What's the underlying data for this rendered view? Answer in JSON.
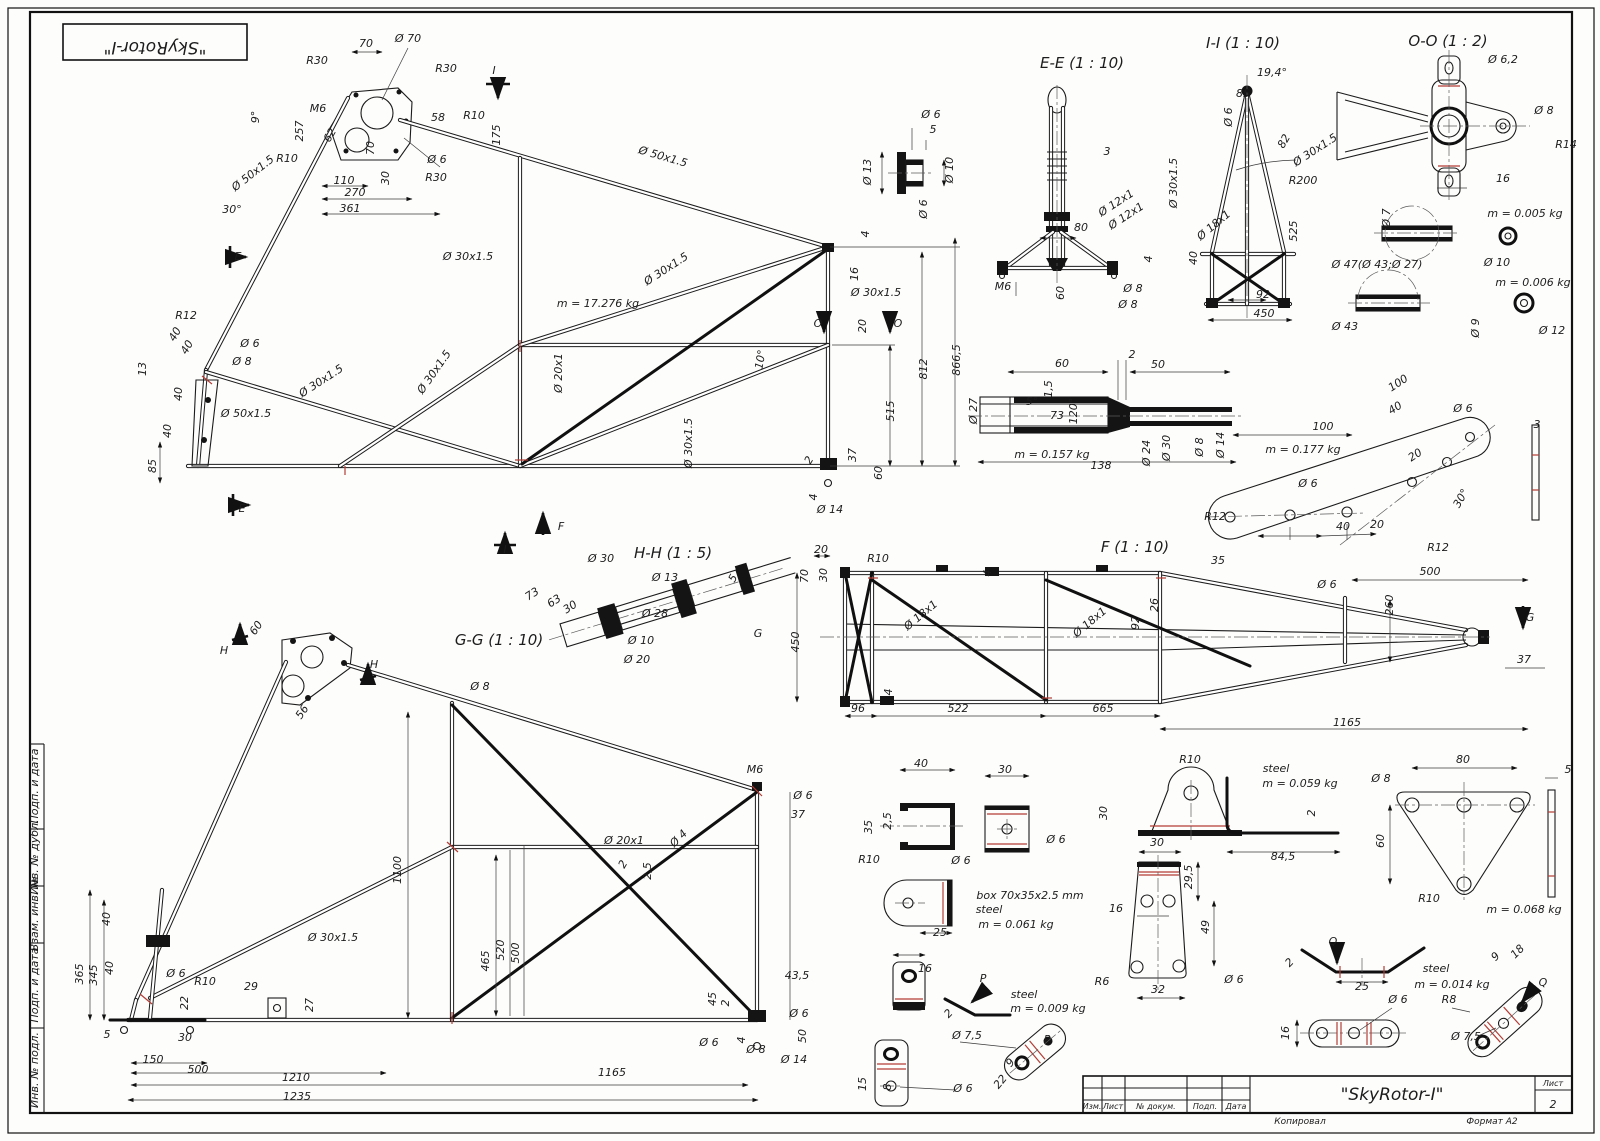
{
  "stamp": {
    "text": "\"SkyRotor-I\""
  },
  "title_block": {
    "title": "\"SkyRotor-I\"",
    "sheet_label": "Лист",
    "sheet_number": "2",
    "col_izm": "Изм.",
    "col_list": "Лист",
    "col_doc": "№ докум.",
    "col_sign": "Подп.",
    "col_date": "Дата",
    "footer_left": "Копировал",
    "footer_right": "Формат А2"
  },
  "views": {
    "section_ee": "E-E (1 : 10)",
    "section_ii": "I-I (1 : 10)",
    "section_oo": "O-O (1 : 2)",
    "section_hh": "H-H (1 : 5)",
    "section_gg": "G-G (1 : 10)",
    "view_f": "F (1 : 10)"
  },
  "masses": {
    "main_frame": "m = 17.276 kg",
    "coupler": "m = 0.157 kg",
    "strap": "m = 0.177 kg",
    "washer_small": "m = 0.005 kg",
    "washer_big": "m = 0.006 kg",
    "u_bracket": "m = 0.061 kg",
    "angle": "m = 0.059 kg",
    "triangle": "m = 0.068 kg",
    "p_bracket": "m = 0.009 kg",
    "q_bracket": "m = 0.014 kg"
  },
  "annotations": [
    {
      "t": "R30",
      "x": 317,
      "y": 64
    },
    {
      "t": "70",
      "x": 366,
      "y": 47
    },
    {
      "t": "Ø 70",
      "x": 408,
      "y": 42
    },
    {
      "t": "R30",
      "x": 446,
      "y": 72
    },
    {
      "t": "I",
      "x": 494,
      "y": 74,
      "fs": 14
    },
    {
      "t": "M6",
      "x": 318,
      "y": 112
    },
    {
      "t": "257",
      "x": 303,
      "y": 131,
      "r": -90
    },
    {
      "t": "9°",
      "x": 259,
      "y": 117,
      "r": -90
    },
    {
      "t": "62",
      "x": 333,
      "y": 137,
      "r": -60
    },
    {
      "t": "58",
      "x": 438,
      "y": 121
    },
    {
      "t": "R10",
      "x": 474,
      "y": 119
    },
    {
      "t": "175",
      "x": 500,
      "y": 135,
      "r": -90
    },
    {
      "t": "R10",
      "x": 287,
      "y": 162
    },
    {
      "t": "110",
      "x": 344,
      "y": 184
    },
    {
      "t": "70",
      "x": 374,
      "y": 148,
      "r": -90
    },
    {
      "t": "30",
      "x": 389,
      "y": 178,
      "r": -90
    },
    {
      "t": "Ø 6",
      "x": 437,
      "y": 163
    },
    {
      "t": "R30",
      "x": 436,
      "y": 181
    },
    {
      "t": "270",
      "x": 355,
      "y": 196
    },
    {
      "t": "361",
      "x": 350,
      "y": 212
    },
    {
      "t": "Ø 50x1.5",
      "x": 255,
      "y": 176,
      "r": -38
    },
    {
      "t": "30°",
      "x": 232,
      "y": 213
    },
    {
      "t": "Ø 50x1.5",
      "x": 662,
      "y": 160,
      "r": 16
    },
    {
      "t": "E",
      "x": 238,
      "y": 260,
      "fs": 14
    },
    {
      "t": "E",
      "x": 242,
      "y": 512,
      "fs": 14
    },
    {
      "t": "R12",
      "x": 186,
      "y": 319
    },
    {
      "t": "40",
      "x": 178,
      "y": 336,
      "r": -60
    },
    {
      "t": "40",
      "x": 190,
      "y": 349,
      "r": -60
    },
    {
      "t": "13",
      "x": 146,
      "y": 369,
      "r": -90
    },
    {
      "t": "Ø 6",
      "x": 250,
      "y": 347
    },
    {
      "t": "Ø 8",
      "x": 242,
      "y": 365
    },
    {
      "t": "40",
      "x": 182,
      "y": 394,
      "r": -90
    },
    {
      "t": "40",
      "x": 171,
      "y": 431,
      "r": -90
    },
    {
      "t": "Ø 50x1.5",
      "x": 246,
      "y": 417
    },
    {
      "t": "Ø 30x1.5",
      "x": 323,
      "y": 384,
      "r": -33
    },
    {
      "t": "85",
      "x": 156,
      "y": 466,
      "r": -90
    },
    {
      "t": "m = 17.276 kg",
      "x": 598,
      "y": 307,
      "fs": 12
    },
    {
      "t": "Ø 30x1.5",
      "x": 468,
      "y": 260
    },
    {
      "t": "Ø 30x1.5",
      "x": 668,
      "y": 272,
      "r": -33
    },
    {
      "t": "Ø 30x1.5",
      "x": 437,
      "y": 374,
      "r": -55
    },
    {
      "t": "Ø 20x1",
      "x": 562,
      "y": 373,
      "r": -90
    },
    {
      "t": "Ø 30x1.5",
      "x": 692,
      "y": 443,
      "r": -90
    },
    {
      "t": "10°",
      "x": 764,
      "y": 360,
      "r": -80
    },
    {
      "t": "4",
      "x": 869,
      "y": 234,
      "r": -90
    },
    {
      "t": "16",
      "x": 858,
      "y": 274,
      "r": -90
    },
    {
      "t": "Ø 30x1.5",
      "x": 876,
      "y": 296
    },
    {
      "t": "O",
      "x": 818,
      "y": 327,
      "fs": 14
    },
    {
      "t": "O",
      "x": 898,
      "y": 327,
      "fs": 14
    },
    {
      "t": "20",
      "x": 866,
      "y": 326,
      "r": -90
    },
    {
      "t": "812",
      "x": 927,
      "y": 369,
      "r": -90
    },
    {
      "t": "866,5",
      "x": 960,
      "y": 360,
      "r": -90
    },
    {
      "t": "515",
      "x": 894,
      "y": 411,
      "r": -90
    },
    {
      "t": "37",
      "x": 856,
      "y": 455,
      "r": -90
    },
    {
      "t": "60",
      "x": 882,
      "y": 473,
      "r": -90
    },
    {
      "t": "2",
      "x": 812,
      "y": 462,
      "r": -60
    },
    {
      "t": "4",
      "x": 817,
      "y": 497,
      "r": -90
    },
    {
      "t": "Ø 14",
      "x": 830,
      "y": 513
    },
    {
      "t": "F",
      "x": 561,
      "y": 530,
      "fs": 14
    },
    {
      "t": "I",
      "x": 505,
      "y": 553,
      "fs": 14
    },
    {
      "t": "Ø 6",
      "x": 931,
      "y": 118
    },
    {
      "t": "5",
      "x": 933,
      "y": 133
    },
    {
      "t": "Ø 13",
      "x": 871,
      "y": 172,
      "r": -90
    },
    {
      "t": "Ø 10",
      "x": 953,
      "y": 170,
      "r": -90
    },
    {
      "t": "Ø 6",
      "x": 927,
      "y": 209,
      "r": -90
    },
    {
      "t": "3",
      "x": 1107,
      "y": 155
    },
    {
      "t": "Ø 12x1",
      "x": 1118,
      "y": 206,
      "r": -33
    },
    {
      "t": "Ø 12x1",
      "x": 1128,
      "y": 219,
      "r": -33
    },
    {
      "t": "80",
      "x": 1081,
      "y": 231
    },
    {
      "t": "M6",
      "x": 1003,
      "y": 290
    },
    {
      "t": "60",
      "x": 1064,
      "y": 293,
      "r": -90
    },
    {
      "t": "Ø 8",
      "x": 1133,
      "y": 292
    },
    {
      "t": "Ø 8",
      "x": 1128,
      "y": 308
    },
    {
      "t": "4",
      "x": 1152,
      "y": 259,
      "r": -90
    },
    {
      "t": "19,4°",
      "x": 1272,
      "y": 76
    },
    {
      "t": "85",
      "x": 1243,
      "y": 97
    },
    {
      "t": "Ø 6",
      "x": 1232,
      "y": 117,
      "r": -90
    },
    {
      "t": "Ø 30x1.5",
      "x": 1177,
      "y": 183,
      "r": -90
    },
    {
      "t": "82",
      "x": 1287,
      "y": 143,
      "r": -60
    },
    {
      "t": "Ø 30x1.5",
      "x": 1317,
      "y": 153,
      "r": -33
    },
    {
      "t": "R200",
      "x": 1303,
      "y": 184
    },
    {
      "t": "525",
      "x": 1297,
      "y": 231,
      "r": -90
    },
    {
      "t": "Ø 18x1",
      "x": 1216,
      "y": 228,
      "r": -40
    },
    {
      "t": "40",
      "x": 1197,
      "y": 258,
      "r": -90
    },
    {
      "t": "92",
      "x": 1263,
      "y": 298
    },
    {
      "t": "450",
      "x": 1264,
      "y": 317
    },
    {
      "t": "Ø 6,2",
      "x": 1503,
      "y": 63
    },
    {
      "t": "Ø 8",
      "x": 1544,
      "y": 114
    },
    {
      "t": "R14",
      "x": 1566,
      "y": 148
    },
    {
      "t": "16",
      "x": 1503,
      "y": 182
    },
    {
      "t": "Ø 7",
      "x": 1390,
      "y": 218,
      "r": -90
    },
    {
      "t": "m = 0.005 kg",
      "x": 1525,
      "y": 217,
      "fs": 12
    },
    {
      "t": "Ø 47(Ø 43;Ø 27)",
      "x": 1377,
      "y": 268
    },
    {
      "t": "Ø 10",
      "x": 1497,
      "y": 266
    },
    {
      "t": "m = 0.006 kg",
      "x": 1533,
      "y": 286,
      "fs": 12
    },
    {
      "t": "Ø 43",
      "x": 1345,
      "y": 330
    },
    {
      "t": "Ø 9",
      "x": 1479,
      "y": 328,
      "r": -90
    },
    {
      "t": "Ø 12",
      "x": 1552,
      "y": 334
    },
    {
      "t": "60",
      "x": 1062,
      "y": 367
    },
    {
      "t": "2",
      "x": 1132,
      "y": 358
    },
    {
      "t": "50",
      "x": 1158,
      "y": 368
    },
    {
      "t": "1,5",
      "x": 1052,
      "y": 389,
      "r": -90
    },
    {
      "t": "Ø 27",
      "x": 977,
      "y": 411,
      "r": -90
    },
    {
      "t": "5°",
      "x": 1032,
      "y": 405
    },
    {
      "t": "73",
      "x": 1057,
      "y": 419
    },
    {
      "t": "120°",
      "x": 1077,
      "y": 411,
      "r": -90
    },
    {
      "t": "Ø 24",
      "x": 1150,
      "y": 453,
      "r": -90
    },
    {
      "t": "Ø 30",
      "x": 1170,
      "y": 448,
      "r": -90
    },
    {
      "t": "Ø 8",
      "x": 1203,
      "y": 447,
      "r": -90
    },
    {
      "t": "Ø 14",
      "x": 1224,
      "y": 445,
      "r": -90
    },
    {
      "t": "m = 0.157 kg",
      "x": 1052,
      "y": 458,
      "fs": 12
    },
    {
      "t": "138",
      "x": 1101,
      "y": 469
    },
    {
      "t": "100",
      "x": 1400,
      "y": 386,
      "r": -33
    },
    {
      "t": "40",
      "x": 1397,
      "y": 411,
      "r": -33
    },
    {
      "t": "Ø 6",
      "x": 1463,
      "y": 412
    },
    {
      "t": "100",
      "x": 1323,
      "y": 430
    },
    {
      "t": "m = 0.177 kg",
      "x": 1303,
      "y": 453,
      "fs": 12
    },
    {
      "t": "20",
      "x": 1417,
      "y": 458,
      "r": -33
    },
    {
      "t": "Ø 6",
      "x": 1308,
      "y": 487
    },
    {
      "t": "R12",
      "x": 1215,
      "y": 520
    },
    {
      "t": "40",
      "x": 1343,
      "y": 530
    },
    {
      "t": "20",
      "x": 1377,
      "y": 528
    },
    {
      "t": "30°",
      "x": 1464,
      "y": 500,
      "r": -60
    },
    {
      "t": "R12",
      "x": 1438,
      "y": 551
    },
    {
      "t": "3",
      "x": 1537,
      "y": 428
    },
    {
      "t": "Ø 30",
      "x": 601,
      "y": 562
    },
    {
      "t": "Ø 13",
      "x": 665,
      "y": 581
    },
    {
      "t": "73",
      "x": 534,
      "y": 597,
      "r": -33
    },
    {
      "t": "63",
      "x": 556,
      "y": 604,
      "r": -33
    },
    {
      "t": "30",
      "x": 572,
      "y": 610,
      "r": -33
    },
    {
      "t": "Ø 28",
      "x": 655,
      "y": 617
    },
    {
      "t": "5",
      "x": 736,
      "y": 580,
      "r": -60
    },
    {
      "t": "Ø 10",
      "x": 641,
      "y": 644
    },
    {
      "t": "Ø 20",
      "x": 637,
      "y": 663
    },
    {
      "t": "G",
      "x": 758,
      "y": 637,
      "fs": 14
    },
    {
      "t": "Ø 8",
      "x": 480,
      "y": 690
    },
    {
      "t": "20",
      "x": 821,
      "y": 553
    },
    {
      "t": "R10",
      "x": 878,
      "y": 562
    },
    {
      "t": "70",
      "x": 808,
      "y": 576,
      "r": -90
    },
    {
      "t": "30",
      "x": 827,
      "y": 575,
      "r": -90
    },
    {
      "t": "450",
      "x": 799,
      "y": 642,
      "r": -90
    },
    {
      "t": "4",
      "x": 991,
      "y": 573,
      "r": -90
    },
    {
      "t": "Ø 18x1",
      "x": 923,
      "y": 618,
      "r": -40
    },
    {
      "t": "Ø 18x1",
      "x": 1092,
      "y": 625,
      "r": -40
    },
    {
      "t": "92",
      "x": 1139,
      "y": 623,
      "r": -90
    },
    {
      "t": "26",
      "x": 1158,
      "y": 605,
      "r": -90
    },
    {
      "t": "4",
      "x": 892,
      "y": 692,
      "r": -90
    },
    {
      "t": "96",
      "x": 858,
      "y": 712
    },
    {
      "t": "522",
      "x": 958,
      "y": 712
    },
    {
      "t": "665",
      "x": 1103,
      "y": 712
    },
    {
      "t": "1165",
      "x": 1347,
      "y": 726
    },
    {
      "t": "35",
      "x": 1218,
      "y": 564
    },
    {
      "t": "500",
      "x": 1430,
      "y": 575
    },
    {
      "t": "Ø 6",
      "x": 1327,
      "y": 588
    },
    {
      "t": "260",
      "x": 1393,
      "y": 605,
      "r": -90
    },
    {
      "t": "37",
      "x": 1524,
      "y": 663
    },
    {
      "t": "G",
      "x": 1530,
      "y": 621,
      "fs": 14
    },
    {
      "t": "H",
      "x": 224,
      "y": 654,
      "fs": 14
    },
    {
      "t": "H",
      "x": 374,
      "y": 668,
      "fs": 14
    },
    {
      "t": "60",
      "x": 259,
      "y": 630,
      "r": -55
    },
    {
      "t": "56",
      "x": 305,
      "y": 714,
      "r": -55
    },
    {
      "t": "1100",
      "x": 401,
      "y": 870,
      "r": -90
    },
    {
      "t": "40",
      "x": 110,
      "y": 919,
      "r": -90
    },
    {
      "t": "40",
      "x": 113,
      "y": 968,
      "r": -90
    },
    {
      "t": "345",
      "x": 97,
      "y": 975,
      "r": -90
    },
    {
      "t": "365",
      "x": 83,
      "y": 974,
      "r": -90
    },
    {
      "t": "Ø 6",
      "x": 176,
      "y": 977
    },
    {
      "t": "R10",
      "x": 205,
      "y": 985
    },
    {
      "t": "29",
      "x": 251,
      "y": 990
    },
    {
      "t": "22",
      "x": 188,
      "y": 1003,
      "r": -90
    },
    {
      "t": "27",
      "x": 313,
      "y": 1005,
      "r": -90
    },
    {
      "t": "5",
      "x": 107,
      "y": 1038
    },
    {
      "t": "30",
      "x": 185,
      "y": 1041
    },
    {
      "t": "150",
      "x": 153,
      "y": 1063
    },
    {
      "t": "500",
      "x": 198,
      "y": 1073
    },
    {
      "t": "1210",
      "x": 296,
      "y": 1081
    },
    {
      "t": "1235",
      "x": 297,
      "y": 1100
    },
    {
      "t": "Ø 30x1.5",
      "x": 333,
      "y": 941
    },
    {
      "t": "465",
      "x": 489,
      "y": 961,
      "r": -90
    },
    {
      "t": "520",
      "x": 504,
      "y": 950,
      "r": -90
    },
    {
      "t": "500",
      "x": 519,
      "y": 953,
      "r": -90
    },
    {
      "t": "M6",
      "x": 755,
      "y": 773
    },
    {
      "t": "Ø 6",
      "x": 803,
      "y": 799
    },
    {
      "t": "37",
      "x": 798,
      "y": 818
    },
    {
      "t": "Ø 20x1",
      "x": 624,
      "y": 844
    },
    {
      "t": "2",
      "x": 626,
      "y": 866,
      "r": -60
    },
    {
      "t": "2,5",
      "x": 651,
      "y": 871,
      "r": -90
    },
    {
      "t": "Ø 4",
      "x": 681,
      "y": 841,
      "r": -45
    },
    {
      "t": "43,5",
      "x": 797,
      "y": 979
    },
    {
      "t": "45",
      "x": 716,
      "y": 999,
      "r": -90
    },
    {
      "t": "2",
      "x": 729,
      "y": 1003,
      "r": -90
    },
    {
      "t": "Ø 6",
      "x": 709,
      "y": 1046
    },
    {
      "t": "4",
      "x": 745,
      "y": 1040,
      "r": -90
    },
    {
      "t": "Ø 8",
      "x": 756,
      "y": 1053
    },
    {
      "t": "Ø 6",
      "x": 799,
      "y": 1017
    },
    {
      "t": "Ø 14",
      "x": 794,
      "y": 1063
    },
    {
      "t": "50",
      "x": 806,
      "y": 1036,
      "r": -90
    },
    {
      "t": "1165",
      "x": 612,
      "y": 1076
    },
    {
      "t": "40",
      "x": 921,
      "y": 767
    },
    {
      "t": "30",
      "x": 1005,
      "y": 773
    },
    {
      "t": "35",
      "x": 872,
      "y": 827,
      "r": -90
    },
    {
      "t": "2,5",
      "x": 891,
      "y": 821,
      "r": -90
    },
    {
      "t": "Ø 6",
      "x": 1056,
      "y": 843
    },
    {
      "t": "R10",
      "x": 869,
      "y": 863
    },
    {
      "t": "Ø 6",
      "x": 961,
      "y": 864
    },
    {
      "t": "box 70x35x2.5 mm",
      "x": 1030,
      "y": 899,
      "fs": 12
    },
    {
      "t": "steel",
      "x": 989,
      "y": 913,
      "fs": 12
    },
    {
      "t": "m = 0.061 kg",
      "x": 1016,
      "y": 928,
      "fs": 12
    },
    {
      "t": "25",
      "x": 940,
      "y": 936
    },
    {
      "t": "R10",
      "x": 1190,
      "y": 763
    },
    {
      "t": "steel",
      "x": 1276,
      "y": 772,
      "fs": 12
    },
    {
      "t": "m = 0.059 kg",
      "x": 1300,
      "y": 787,
      "fs": 12
    },
    {
      "t": "30",
      "x": 1107,
      "y": 813,
      "r": -90
    },
    {
      "t": "2",
      "x": 1315,
      "y": 813,
      "r": -90
    },
    {
      "t": "30",
      "x": 1157,
      "y": 846
    },
    {
      "t": "84,5",
      "x": 1283,
      "y": 860
    },
    {
      "t": "29,5",
      "x": 1192,
      "y": 877,
      "r": -90
    },
    {
      "t": "16",
      "x": 1116,
      "y": 912
    },
    {
      "t": "49",
      "x": 1209,
      "y": 927,
      "r": -90
    },
    {
      "t": "R6",
      "x": 1102,
      "y": 985
    },
    {
      "t": "32",
      "x": 1158,
      "y": 993
    },
    {
      "t": "Ø 6",
      "x": 1234,
      "y": 983
    },
    {
      "t": "2",
      "x": 1292,
      "y": 965,
      "r": -45
    },
    {
      "t": "Q",
      "x": 1333,
      "y": 945,
      "fs": 14
    },
    {
      "t": "25",
      "x": 1362,
      "y": 990
    },
    {
      "t": "steel",
      "x": 1436,
      "y": 972,
      "fs": 12
    },
    {
      "t": "m = 0.014 kg",
      "x": 1452,
      "y": 988,
      "fs": 12
    },
    {
      "t": "80",
      "x": 1463,
      "y": 763
    },
    {
      "t": "5",
      "x": 1568,
      "y": 773
    },
    {
      "t": "Ø 8",
      "x": 1381,
      "y": 782
    },
    {
      "t": "60",
      "x": 1384,
      "y": 841,
      "r": -90
    },
    {
      "t": "R10",
      "x": 1429,
      "y": 902
    },
    {
      "t": "m = 0.068 kg",
      "x": 1524,
      "y": 913,
      "fs": 12
    },
    {
      "t": "9",
      "x": 1498,
      "y": 959,
      "r": -45
    },
    {
      "t": "18",
      "x": 1520,
      "y": 954,
      "r": -45
    },
    {
      "t": "Q",
      "x": 1543,
      "y": 986,
      "fs": 14
    },
    {
      "t": "Ø 6",
      "x": 1398,
      "y": 1003
    },
    {
      "t": "R8",
      "x": 1449,
      "y": 1003
    },
    {
      "t": "Ø 7,5",
      "x": 1466,
      "y": 1040
    },
    {
      "t": "16",
      "x": 1289,
      "y": 1033,
      "r": -90
    },
    {
      "t": "16",
      "x": 925,
      "y": 972
    },
    {
      "t": "P",
      "x": 983,
      "y": 982,
      "fs": 14
    },
    {
      "t": "2",
      "x": 951,
      "y": 1016,
      "r": -45
    },
    {
      "t": "steel",
      "x": 1024,
      "y": 998,
      "fs": 12
    },
    {
      "t": "m = 0.009 kg",
      "x": 1048,
      "y": 1012,
      "fs": 12
    },
    {
      "t": "Ø 7,5",
      "x": 967,
      "y": 1039
    },
    {
      "t": "P",
      "x": 1047,
      "y": 1043,
      "fs": 14
    },
    {
      "t": "15",
      "x": 866,
      "y": 1084,
      "r": -90
    },
    {
      "t": "8",
      "x": 891,
      "y": 1087,
      "r": -90
    },
    {
      "t": "Ø 6",
      "x": 963,
      "y": 1092
    },
    {
      "t": "9",
      "x": 1013,
      "y": 1065,
      "r": -50
    },
    {
      "t": "22",
      "x": 1003,
      "y": 1084,
      "r": -50
    },
    {
      "t": "Подп. и дата",
      "x": 38,
      "y": 786,
      "r": -90,
      "fs": 8
    },
    {
      "t": "Инв. № дубл.",
      "x": 38,
      "y": 857,
      "r": -90,
      "fs": 8
    },
    {
      "t": "Взам. инв. №",
      "x": 38,
      "y": 914,
      "r": -90,
      "fs": 8
    },
    {
      "t": "Подп. и дата",
      "x": 38,
      "y": 985,
      "r": -90,
      "fs": 8
    },
    {
      "t": "Инв. № подл.",
      "x": 38,
      "y": 1070,
      "r": -90,
      "fs": 8
    }
  ]
}
